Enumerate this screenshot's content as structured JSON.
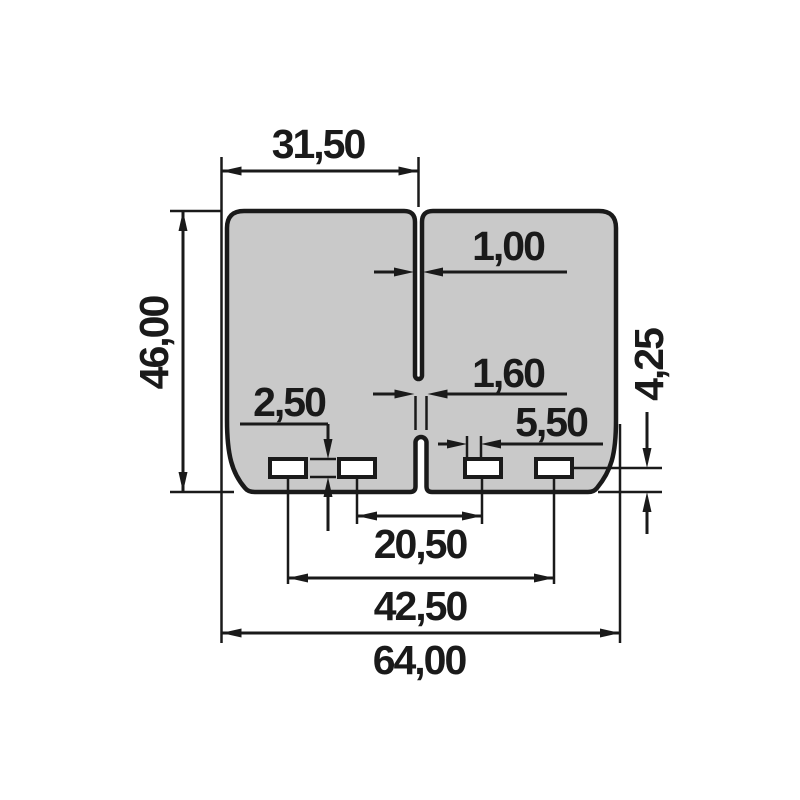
{
  "drawing": {
    "type": "technical-dimension-drawing",
    "part": "reed-valve-petal-sheet",
    "colors": {
      "background": "#ffffff",
      "part_fill": "#c9c9c9",
      "line": "#1a1a1a"
    },
    "dimensions": {
      "petal_width": "31,50",
      "slit_width": "1,00",
      "center_gap_width": "1,60",
      "slot_height": "2,50",
      "slot_width": "5,50",
      "overall_height": "46,00",
      "slot_bottom_offset": "4,25",
      "inner_slot_spacing": "20,50",
      "outer_slot_spacing": "42,50",
      "overall_width": "64,00"
    }
  }
}
